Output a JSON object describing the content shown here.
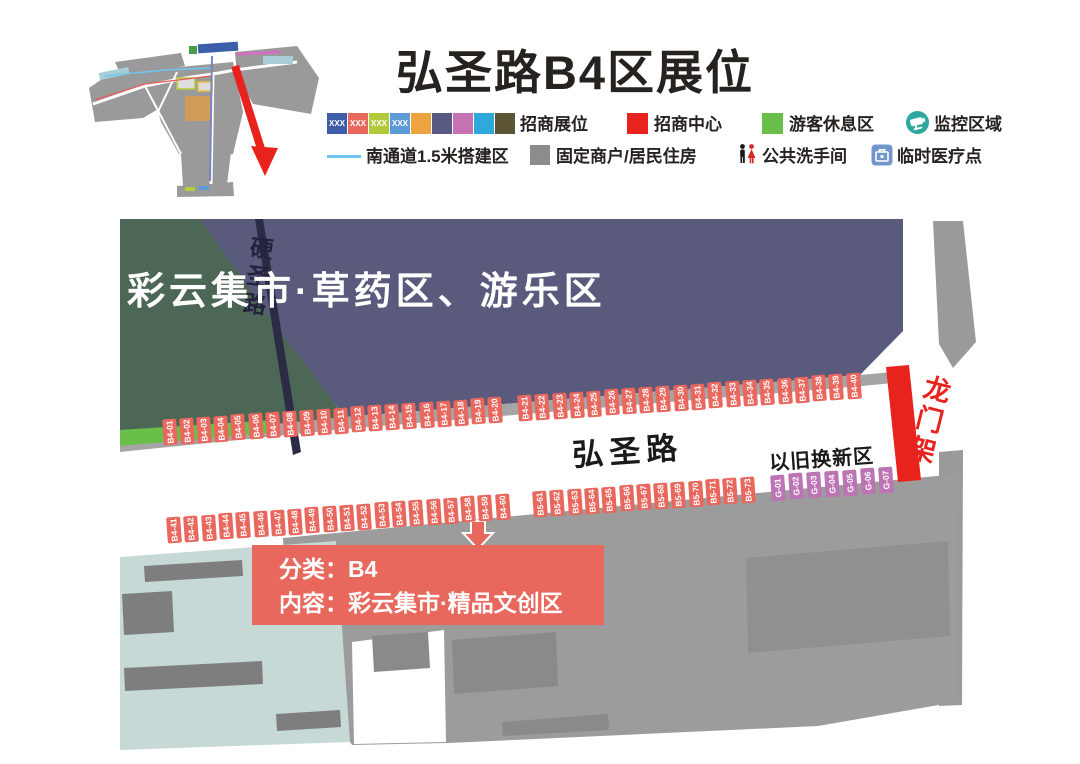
{
  "title": "弘圣路B4区展位",
  "legend": {
    "booth_swatches": [
      {
        "color": "#3E5CA8",
        "text": "XXX"
      },
      {
        "color": "#E8685E",
        "text": "XXX"
      },
      {
        "color": "#B2C93B",
        "text": "XXX"
      },
      {
        "color": "#5C9BD5",
        "text": "XXX"
      },
      {
        "color": "#EDA33F",
        "text": ""
      },
      {
        "color": "#585A84",
        "text": ""
      },
      {
        "color": "#C573B5",
        "text": ""
      },
      {
        "color": "#2FA8DC",
        "text": ""
      },
      {
        "color": "#5C5636",
        "text": ""
      }
    ],
    "labels": {
      "booths": "招商展位",
      "center": "招商中心",
      "rest": "游客休息区",
      "monitor": "监控区域",
      "channel": "南通道1.5米搭建区",
      "fixed": "固定商户/居民住房",
      "wc": "公共洗手间",
      "medical": "临时医疗点"
    },
    "colors": {
      "center_square": "#E8231D",
      "rest_square": "#6ABF4B",
      "fixed_square": "#8C8C8C",
      "channel_line": "#6EC6F0",
      "monitor_circle": "#2EA89E",
      "medical_box": "#7096CC"
    }
  },
  "map": {
    "zone_title": "彩云集市·草药区、游乐区",
    "road_label": "弘圣路",
    "crossroad_label": "硬圣路",
    "tradein_label": "以旧换新区",
    "gantry_label": "龙门架",
    "callout": {
      "line1": "分类：B4",
      "line2": "内容：彩云集市·精品文创区"
    },
    "colors": {
      "booth_salmon": "#E8685E",
      "booth_purple": "#BC74B4",
      "zone_block": "#5A5A7C",
      "gantry_red": "#E8231D",
      "rest_green": "#6ABF4B",
      "dark_green": "#4D6757",
      "residential_gray": "#9C9C9C",
      "pale_teal": "#C7D9D6"
    },
    "booth_groups": [
      {
        "key": "row1a",
        "color": "#E8685E",
        "ids": [
          "B4-01",
          "B4-02",
          "B4-03",
          "B4-04",
          "B4-05",
          "B4-06",
          "B4-07",
          "B4-08",
          "B4-09",
          "B4-10",
          "B4-11",
          "B4-12",
          "B4-13",
          "B4-14",
          "B4-15",
          "B4-16",
          "B4-17",
          "B4-18",
          "B4-19",
          "B4-20"
        ]
      },
      {
        "key": "row1b",
        "color": "#E8685E",
        "ids": [
          "B4-21",
          "B4-22",
          "B4-23",
          "B4-24",
          "B4-25",
          "B4-26",
          "B4-27",
          "B4-28",
          "B4-29",
          "B4-30",
          "B4-31",
          "B4-32",
          "B4-33",
          "B4-34",
          "B4-35",
          "B4-36",
          "B4-37",
          "B4-38",
          "B4-39",
          "B4-40"
        ]
      },
      {
        "key": "row2a",
        "color": "#E8685E",
        "ids": [
          "B4-41",
          "B4-42",
          "B4-43",
          "B4-44",
          "B4-45",
          "B4-46",
          "B4-47",
          "B4-48",
          "B4-49",
          "B4-50",
          "B4-51",
          "B4-52",
          "B4-53",
          "B4-54",
          "B4-55",
          "B4-56",
          "B4-57",
          "B4-58",
          "B4-59",
          "B4-60"
        ]
      },
      {
        "key": "row2b",
        "color": "#E8685E",
        "ids": [
          "B5-61",
          "B5-62",
          "B5-63",
          "B5-64",
          "B5-65",
          "B5-66",
          "B5-67",
          "B5-68",
          "B5-69",
          "B5-70",
          "B5-71",
          "B5-72",
          "B5-73"
        ]
      },
      {
        "key": "row2c",
        "color": "#BC74B4",
        "ids": [
          "G-01",
          "G-02",
          "G-03",
          "G-04",
          "G-05",
          "G-06",
          "G-07"
        ]
      }
    ]
  }
}
